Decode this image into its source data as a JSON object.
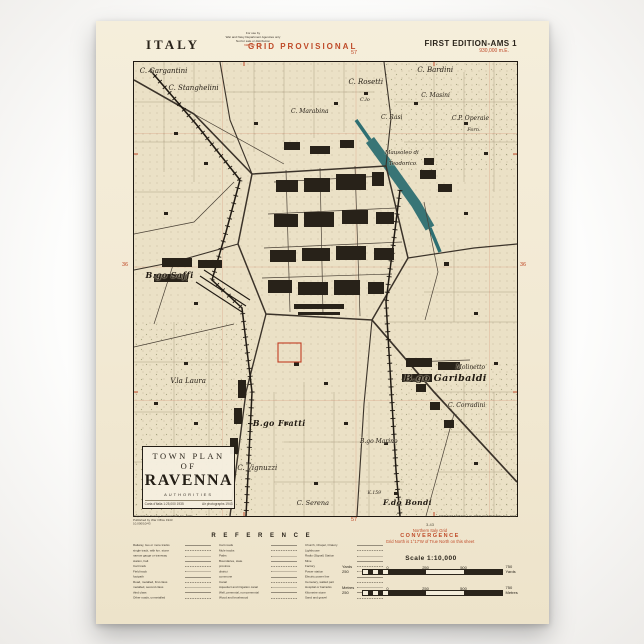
{
  "colors": {
    "paper": "#f2e9d3",
    "map_background": "#ebe1c6",
    "ink": "#2a241b",
    "accent_red": "#bf4a28",
    "canal_teal": "#2e6f72"
  },
  "header": {
    "country": "ITALY",
    "restriction_lines": [
      "For use by",
      "War and Navy Department Agencies only",
      "Not for sale or distribution"
    ],
    "restriction_grid": "698,000 m.E.",
    "series_title": "GRID PROVISIONAL",
    "grid_top": "57",
    "edition": "FIRST EDITION-AMS 1",
    "edition_grid": "930,000 m.E."
  },
  "map": {
    "margin_left": "36",
    "margin_right": "36",
    "labels": [
      {
        "text": "C. Gargantini",
        "x": 1.5,
        "y": 1.2,
        "s": 7
      },
      {
        "text": "C. Stanghelini",
        "x": 9,
        "y": 4.8,
        "s": 7
      },
      {
        "text": "C. Marabina",
        "x": 41,
        "y": 10.2,
        "s": 6
      },
      {
        "text": "C. Rosetti",
        "x": 56,
        "y": 3.6,
        "s": 7
      },
      {
        "text": "C.lo",
        "x": 59,
        "y": 7.8,
        "s": 5
      },
      {
        "text": "C. Bardini",
        "x": 74,
        "y": 0.8,
        "s": 7
      },
      {
        "text": "C. Masini",
        "x": 75,
        "y": 6.6,
        "s": 6
      },
      {
        "text": "C. Rasi",
        "x": 64.5,
        "y": 11.4,
        "s": 6
      },
      {
        "text": "C.P. Operaie",
        "x": 83,
        "y": 11.6,
        "s": 6
      },
      {
        "text": "Forn.",
        "x": 87,
        "y": 14.4,
        "s": 5
      },
      {
        "text": "Mausoleo di",
        "x": 65.5,
        "y": 19.4,
        "s": 5.5
      },
      {
        "text": "Teodorico",
        "x": 66.5,
        "y": 21.8,
        "s": 5.5
      },
      {
        "text": "B.go Saffi",
        "x": 3,
        "y": 45.8,
        "s": 8,
        "b": 1
      },
      {
        "text": "V.la Laura",
        "x": 9.5,
        "y": 69.4,
        "s": 7
      },
      {
        "text": "B.go Garibaldi",
        "x": 70.5,
        "y": 68.4,
        "s": 9.5,
        "b": 1
      },
      {
        "text": "Molinetto",
        "x": 84,
        "y": 66.6,
        "s": 6
      },
      {
        "text": "C. Corradini",
        "x": 82,
        "y": 74.8,
        "s": 6
      },
      {
        "text": "B.go Fratti",
        "x": 31,
        "y": 78.4,
        "s": 8,
        "b": 1
      },
      {
        "text": "B.go Marino",
        "x": 59,
        "y": 82.8,
        "s": 6
      },
      {
        "text": "C. Vignuzzi",
        "x": 27,
        "y": 88.6,
        "s": 7
      },
      {
        "text": "K.159",
        "x": 61,
        "y": 94.4,
        "s": 4.5
      },
      {
        "text": "C. Serena",
        "x": 42.5,
        "y": 96.2,
        "s": 6.5
      },
      {
        "text": "F.do Bondi",
        "x": 65,
        "y": 96,
        "s": 7.5,
        "b": 1
      }
    ],
    "title_block": {
      "line1": "TOWN PLAN OF",
      "line2": "RAVENNA",
      "line3": "AUTHORITIES",
      "credit_left": "Carta d'Italia 1:25,000  1935",
      "credit_right": "Air photographs 1943"
    }
  },
  "footer": {
    "publisher_lines": [
      "Preparation: Survey, General Staff, No. 4080",
      "Published by War Office 1943",
      "10,000/10/43"
    ],
    "reference_title": "R E F E R E N C E",
    "legend": {
      "col1": [
        "Railway, two or more tracks",
        "  single track, with km. stone",
        "  narrow gauge or tramway",
        "  station, halt",
        "Cart track",
        "Field track",
        "  footpath",
        "Road, metalled, first class",
        "  metalled, second class",
        "  third class",
        "Other roads, unmetalled"
      ],
      "col2": [
        "Cart roads",
        "Mule tracks",
        "Paths",
        "Boundaries, state",
        "  province",
        "  district",
        "  commune",
        "Canal",
        "Aqueduct and irrigation canal",
        "Well, perennial, non-perennial",
        "Wood and brushwood"
      ],
      "col3": [
        "Church, Chapel, Oratory",
        "Lighthouse",
        "Radio (Signal) Station",
        "Mine",
        "Factory",
        "Power station",
        "Electric power line",
        "Cemetery, walled part",
        "Hospital or barracks",
        "Kilometre stone",
        "Sand and gravel"
      ]
    },
    "credit_line": "ARMY MAP SERVICE, U.S. ARMY, WASHINGTON, D.C., 1943",
    "print_code": "3-43",
    "convergence": {
      "line1": "Northern Italy Grid",
      "line2": "CONVERGENCE",
      "line3": "Grid North is 1°17'W of True North on this sheet"
    },
    "scale_title": "Scale 1:10,000",
    "grid_bottom": "57",
    "bars": {
      "yards": {
        "left": "Yards 250",
        "ticks": [
          "0",
          "250",
          "500"
        ],
        "right": "750 Yards"
      },
      "metres": {
        "left": "Metres 250",
        "ticks": [
          "0",
          "250",
          "500"
        ],
        "right": "750 Metres"
      }
    }
  }
}
